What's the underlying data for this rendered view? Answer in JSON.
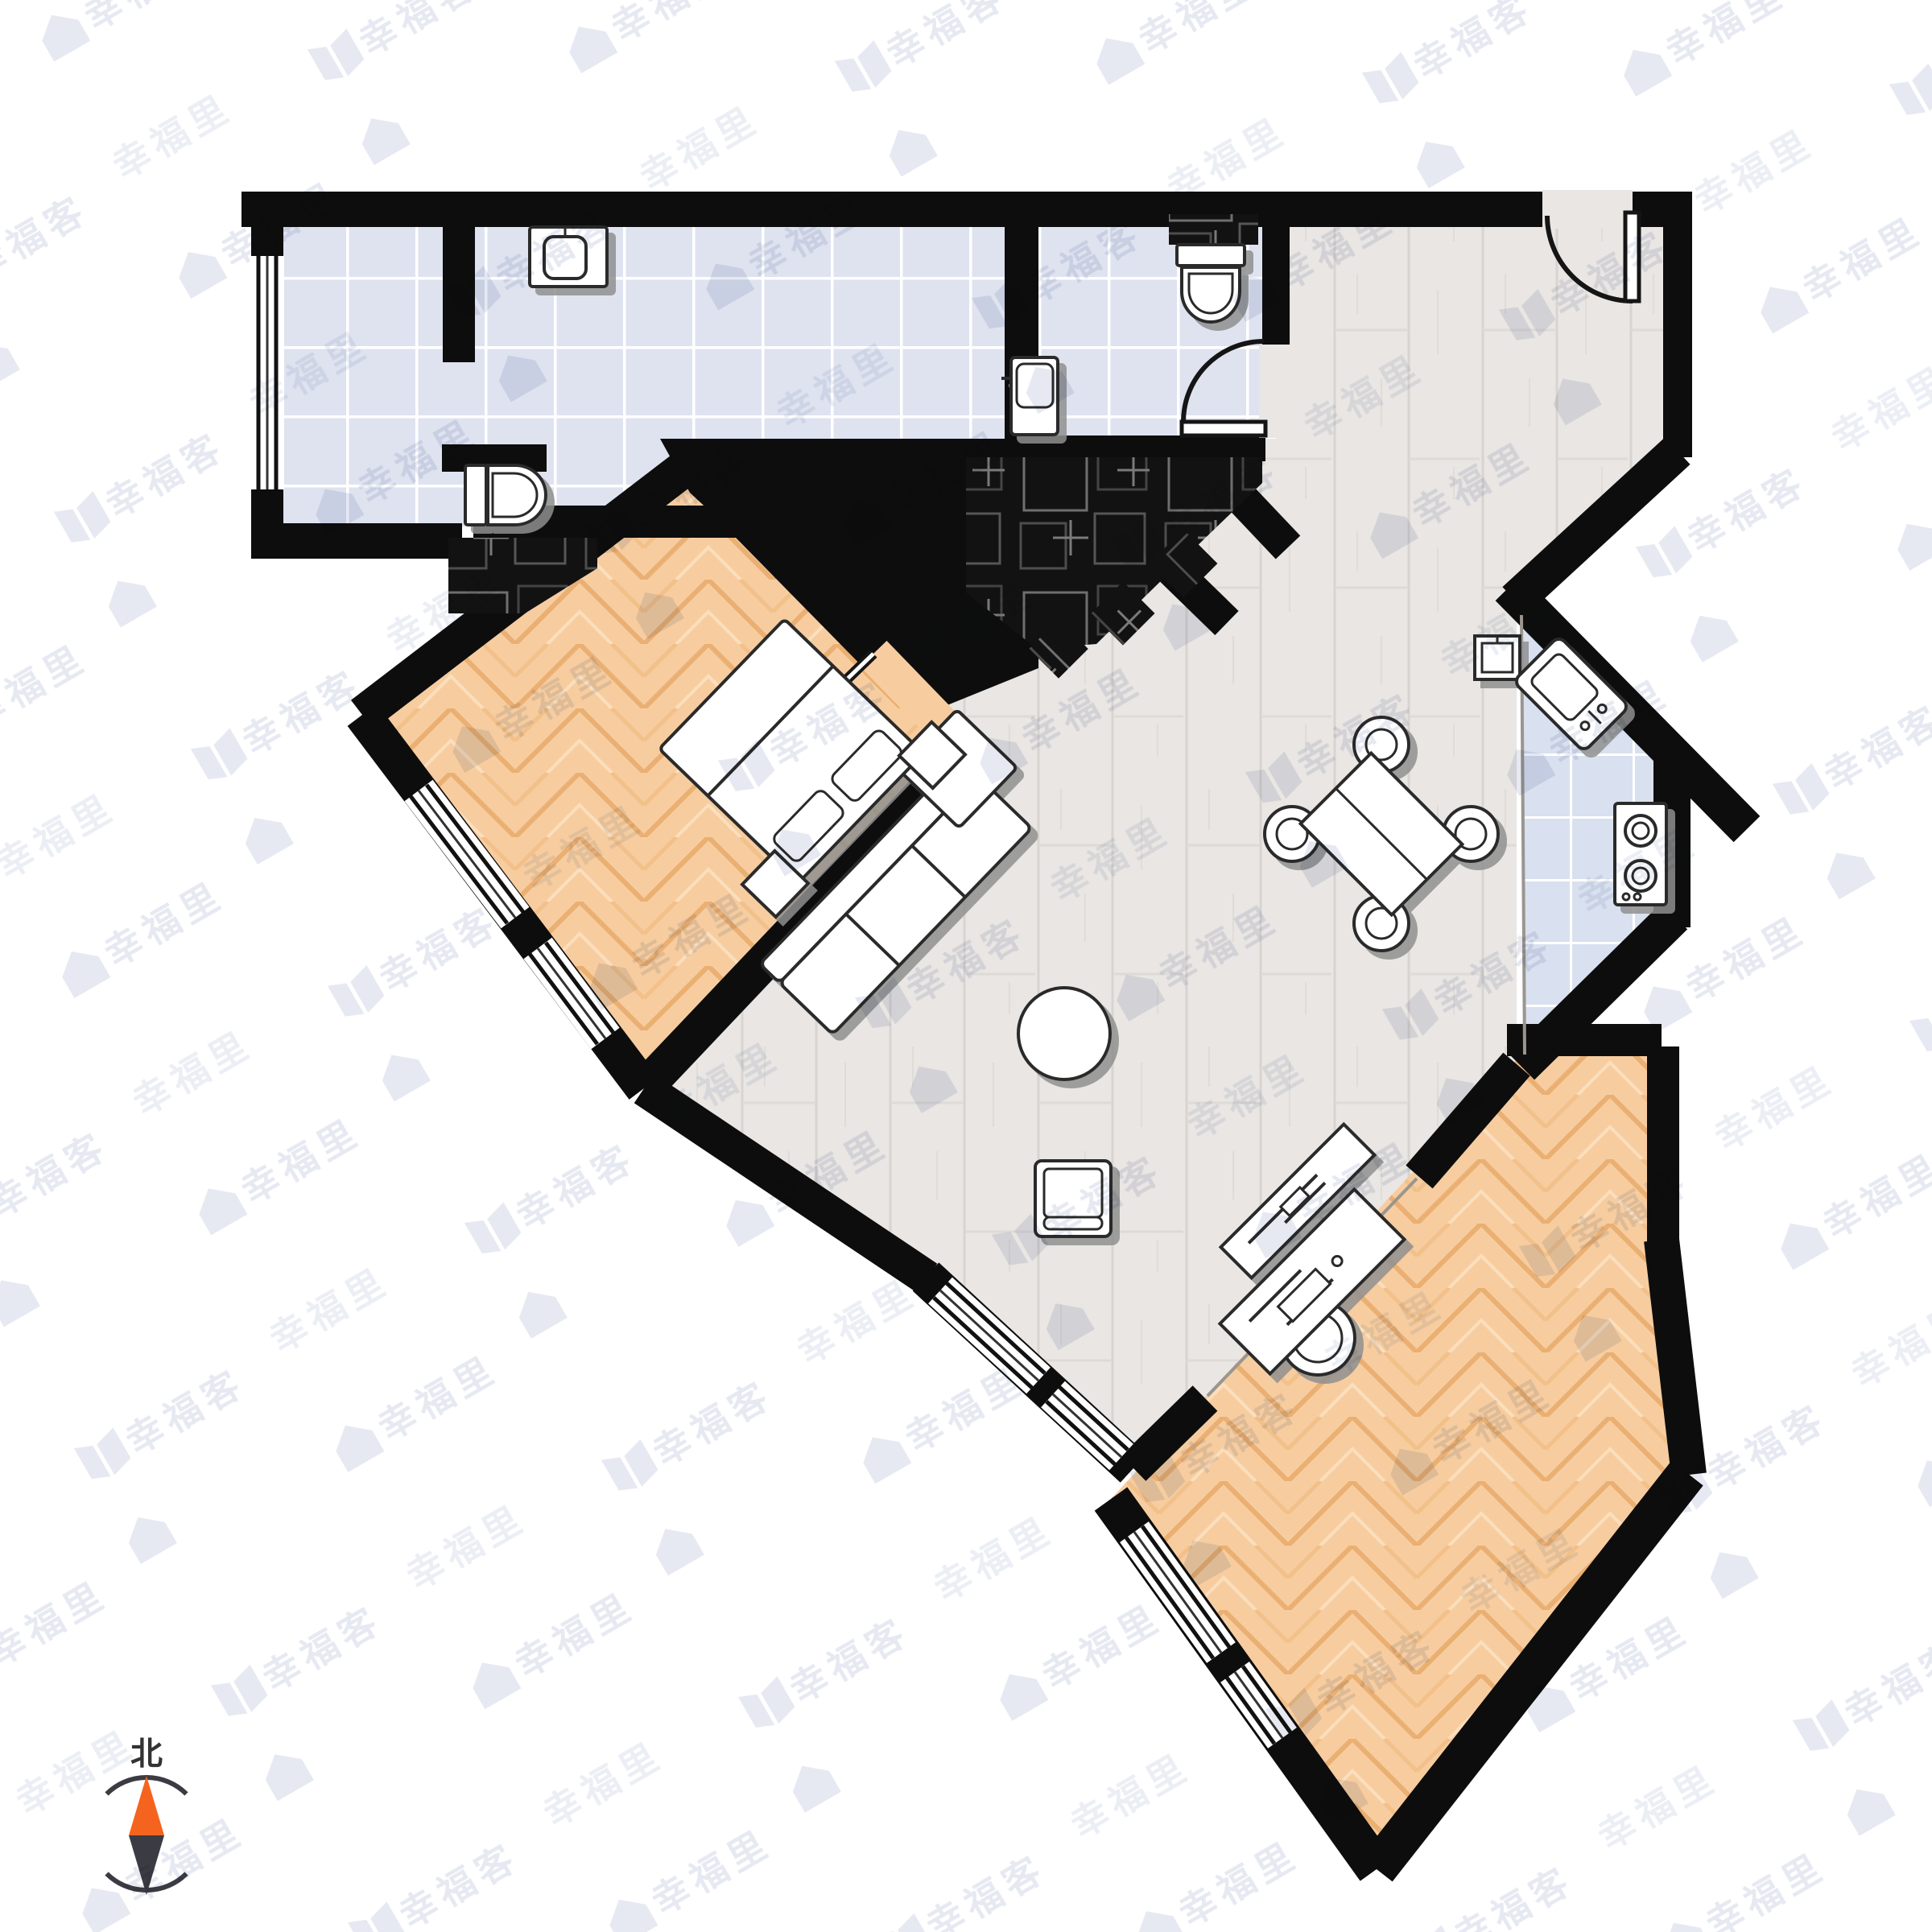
{
  "compass": {
    "label": "北"
  },
  "watermarks": {
    "primary": "幸福里",
    "secondary": "幸福客"
  },
  "colors": {
    "wall": "#0d0d0d",
    "tile_floor": "#dfe3f0",
    "tile_grout": "#ffffff",
    "kitchen_tile": "#d9e0ef",
    "plank_floor": "#e9e6e3",
    "herringbone_floor": "#f7cda0",
    "dark_mosaic": "#121212",
    "furniture_fill": "#ffffff",
    "furniture_stroke": "#2b2b2b",
    "north_arrow": "#f5641f",
    "south_arrow": "#3b3b43",
    "watermark": "#e4e7f0"
  }
}
